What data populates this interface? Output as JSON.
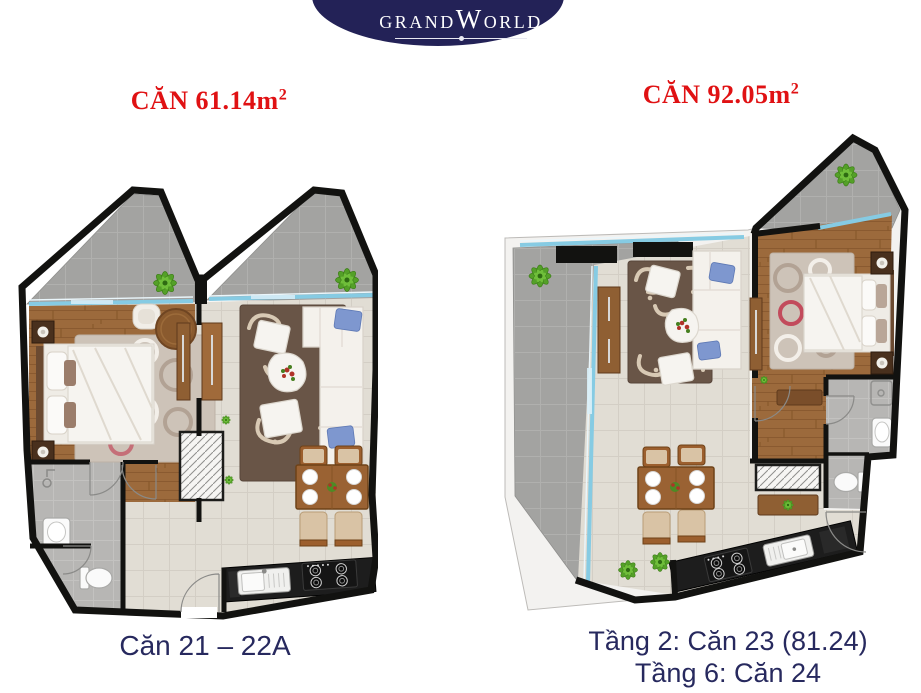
{
  "logo": {
    "part1": "GRAND",
    "part2": "W",
    "part3": "ORLD"
  },
  "labels": {
    "left_area": "CĂN 61.14m",
    "left_area_sup": "2",
    "right_area": "CĂN 92.05m",
    "right_area_sup": "2"
  },
  "captions": {
    "left": "Căn 21 – 22A",
    "right_line1": "Tầng 2: Căn 23 (81.24)",
    "right_line2": "Tầng 6: Căn 24"
  },
  "colors": {
    "page_bg": "#ffffff",
    "accent_red": "#e01113",
    "caption_navy": "#27295e",
    "logo_navy": "#232257",
    "wall_black": "#121210",
    "balcony_gray": "#a3a3a1",
    "tile_floor": "#e1ddd4",
    "wood_floor": "#9c6a3c",
    "rug_dark": "#695547",
    "rug_light": "#cdc3b8",
    "sofa_white": "#f4f1ec",
    "cushion_blue": "#7e97cf",
    "glass_blue": "#86cbe3",
    "plant_green": "#55a22a",
    "counter_black": "#1d1d1d",
    "fixture_white": "#fafafa",
    "chair_beige": "#d9c3a5",
    "chair_wood": "#9c5f2e",
    "bath_gray": "#b7b6b4"
  }
}
